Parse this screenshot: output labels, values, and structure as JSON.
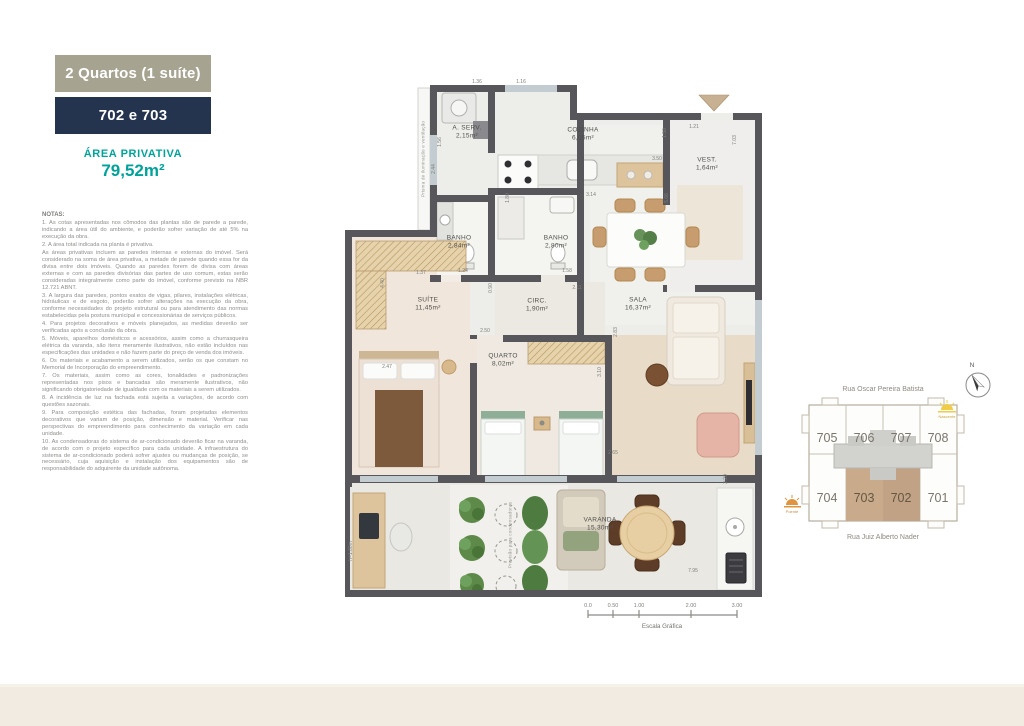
{
  "header": {
    "type_label": "2 Quartos (1 suíte)",
    "type_bg": "#a7a391",
    "units_label": "702 e 703",
    "units_bg": "#24334e",
    "area_title": "ÁREA PRIVATIVA",
    "area_value": "79,52m²",
    "accent_color": "#00a39b"
  },
  "notes": {
    "title": "NOTAS:",
    "lines": [
      "1. As cotas apresentadas nos cômodos das plantas são de parede a parede, indicando a área útil do ambiente, e poderão sofrer variação de até 5% na execução da obra.",
      "2. A área total indicada na planta é privativa.",
      "As áreas privativas incluem as paredes internas e externas do imóvel. Será considerado na soma de área privativa, a metade de parede quando essa for da divisa entre dois imóveis. Quando as paredes forem de divisa com áreas externas e com as paredes divisórias das partes de uso comum, estas serão consideradas integralmente como parte do imóvel, conforme previsto na NBR 12.721 ABNT.",
      "3. A largura das paredes, pontos exatos de vigas, pilares, instalações elétricas, hidráulicas e de esgoto, poderão sofrer alterações na execução da obra, conforme necessidades do projeto estrutural ou para atendimento das normas estabelecidas pela postura municipal e concessionárias de serviços públicos.",
      "4. Para projetos decorativos e móveis planejados, as medidas deverão ser verificadas após a conclusão da obra.",
      "5. Móveis, aparelhos domésticos e acessórios, assim como a churrasqueira elétrica da varanda, são itens meramente ilustrativos, não estão incluídos nas especificações das unidades e não fazem parte do preço de venda dos imóveis.",
      "6. Os materiais e acabamento a serem utilizados, serão os que constam no Memorial de Incorporação do empreendimento.",
      "7. Os materiais, assim como as cores, tonalidades e padronizações representadas nos pisos e bancadas são meramente ilustrativos, não significando obrigatoriedade de igualdade com os materiais a serem utilizados.",
      "8. A incidência de luz na fachada está sujeita a variações, de acordo com questões sazonais.",
      "9. Para composição estética das fachadas, foram projetadas elementos decorativos que variam de posição, dimensão e material. Verificar nas perspectivas do empreendimento para conhecimento da variação em cada unidade.",
      "10. As condensadoras do sistema de ar-condicionado deverão ficar na varanda, de acordo com o projeto específico para cada unidade. A infraestrutura do sistema de ar-condicionado poderá sofrer ajustes ou mudanças de posição, se necessário, cuja aquisição e instalação dos equipamentos são de responsabilidade do adquirente da unidade autônoma."
    ]
  },
  "plan": {
    "wall_color": "#56565b",
    "rooms": [
      {
        "name": "A. SERV.",
        "area": "2,15m²",
        "x": 122,
        "y": 48
      },
      {
        "name": "COZINHA",
        "area": "6,05m²",
        "x": 238,
        "y": 50
      },
      {
        "name": "VEST.",
        "area": "1,64m²",
        "x": 362,
        "y": 80
      },
      {
        "name": "BANHO",
        "area": "2,84m²",
        "x": 114,
        "y": 158
      },
      {
        "name": "BANHO",
        "area": "2,80m²",
        "x": 211,
        "y": 158
      },
      {
        "name": "CIRC.",
        "area": "1,90m²",
        "x": 192,
        "y": 221
      },
      {
        "name": "SALA",
        "area": "16,37m²",
        "x": 293,
        "y": 220
      },
      {
        "name": "SUÍTE",
        "area": "11,45m²",
        "x": 83,
        "y": 220
      },
      {
        "name": "QUARTO",
        "area": "8,02m²",
        "x": 158,
        "y": 276
      },
      {
        "name": "VARANDA",
        "area": "15,30m²",
        "x": 255,
        "y": 440
      }
    ],
    "dims": [
      {
        "t": "1.36",
        "x": 132,
        "y": -3
      },
      {
        "t": "1.16",
        "x": 176,
        "y": -3
      },
      {
        "t": "1.50",
        "x": 320,
        "y": 48,
        "v": 1
      },
      {
        "t": "1.21",
        "x": 349,
        "y": 42
      },
      {
        "t": "7.03",
        "x": 390,
        "y": 55,
        "v": 1
      },
      {
        "t": "1.56",
        "x": 95,
        "y": 57,
        "v": 1
      },
      {
        "t": "2.44",
        "x": 89,
        "y": 84,
        "v": 1
      },
      {
        "t": "1.80",
        "x": 163,
        "y": 113,
        "v": 1
      },
      {
        "t": "3.14",
        "x": 246,
        "y": 110
      },
      {
        "t": "5.66",
        "x": 322,
        "y": 113,
        "v": 1
      },
      {
        "t": "3.50",
        "x": 312,
        "y": 74
      },
      {
        "t": "1.24",
        "x": 118,
        "y": 186
      },
      {
        "t": "1.37",
        "x": 76,
        "y": 188
      },
      {
        "t": "1.58",
        "x": 222,
        "y": 186
      },
      {
        "t": "2.11",
        "x": 232,
        "y": 203
      },
      {
        "t": "0.90",
        "x": 146,
        "y": 203,
        "v": 1
      },
      {
        "t": "4.40",
        "x": 38,
        "y": 198,
        "v": 1
      },
      {
        "t": "2.47",
        "x": 42,
        "y": 282
      },
      {
        "t": "2.50",
        "x": 140,
        "y": 246
      },
      {
        "t": "2.83",
        "x": 271,
        "y": 247,
        "v": 1
      },
      {
        "t": "3.10",
        "x": 255,
        "y": 287,
        "v": 1
      },
      {
        "t": "2.65",
        "x": 268,
        "y": 368
      },
      {
        "t": "2.20",
        "x": 381,
        "y": 394,
        "v": 1
      },
      {
        "t": "7.95",
        "x": 348,
        "y": 486
      },
      {
        "t": "h=1.80m",
        "x": 6,
        "y": 466,
        "v": 1
      }
    ],
    "annotations": [
      {
        "t": "Prisma de iluminação e ventilação",
        "x": 78,
        "y": 74
      },
      {
        "t": "Previsão para condensadoras",
        "x": 165,
        "y": 450
      }
    ]
  },
  "scale_bar": {
    "ticks": [
      "0.0",
      "0.50",
      "1.00",
      "2.00",
      "3.00"
    ],
    "label": "Escala Gráfica"
  },
  "keyplan": {
    "street_top": "Rua Oscar Pereira Batista",
    "street_bottom": "Rua Juiz Alberto Nader",
    "north_label": "N",
    "sun_right": "Nascente",
    "sun_left": "Poente",
    "units_top": [
      "705",
      "706",
      "707",
      "708"
    ],
    "units_bottom": [
      "704",
      "703",
      "702",
      "701"
    ],
    "highlighted_units": [
      "703",
      "702"
    ],
    "highlight_color": "#c7a98a"
  }
}
